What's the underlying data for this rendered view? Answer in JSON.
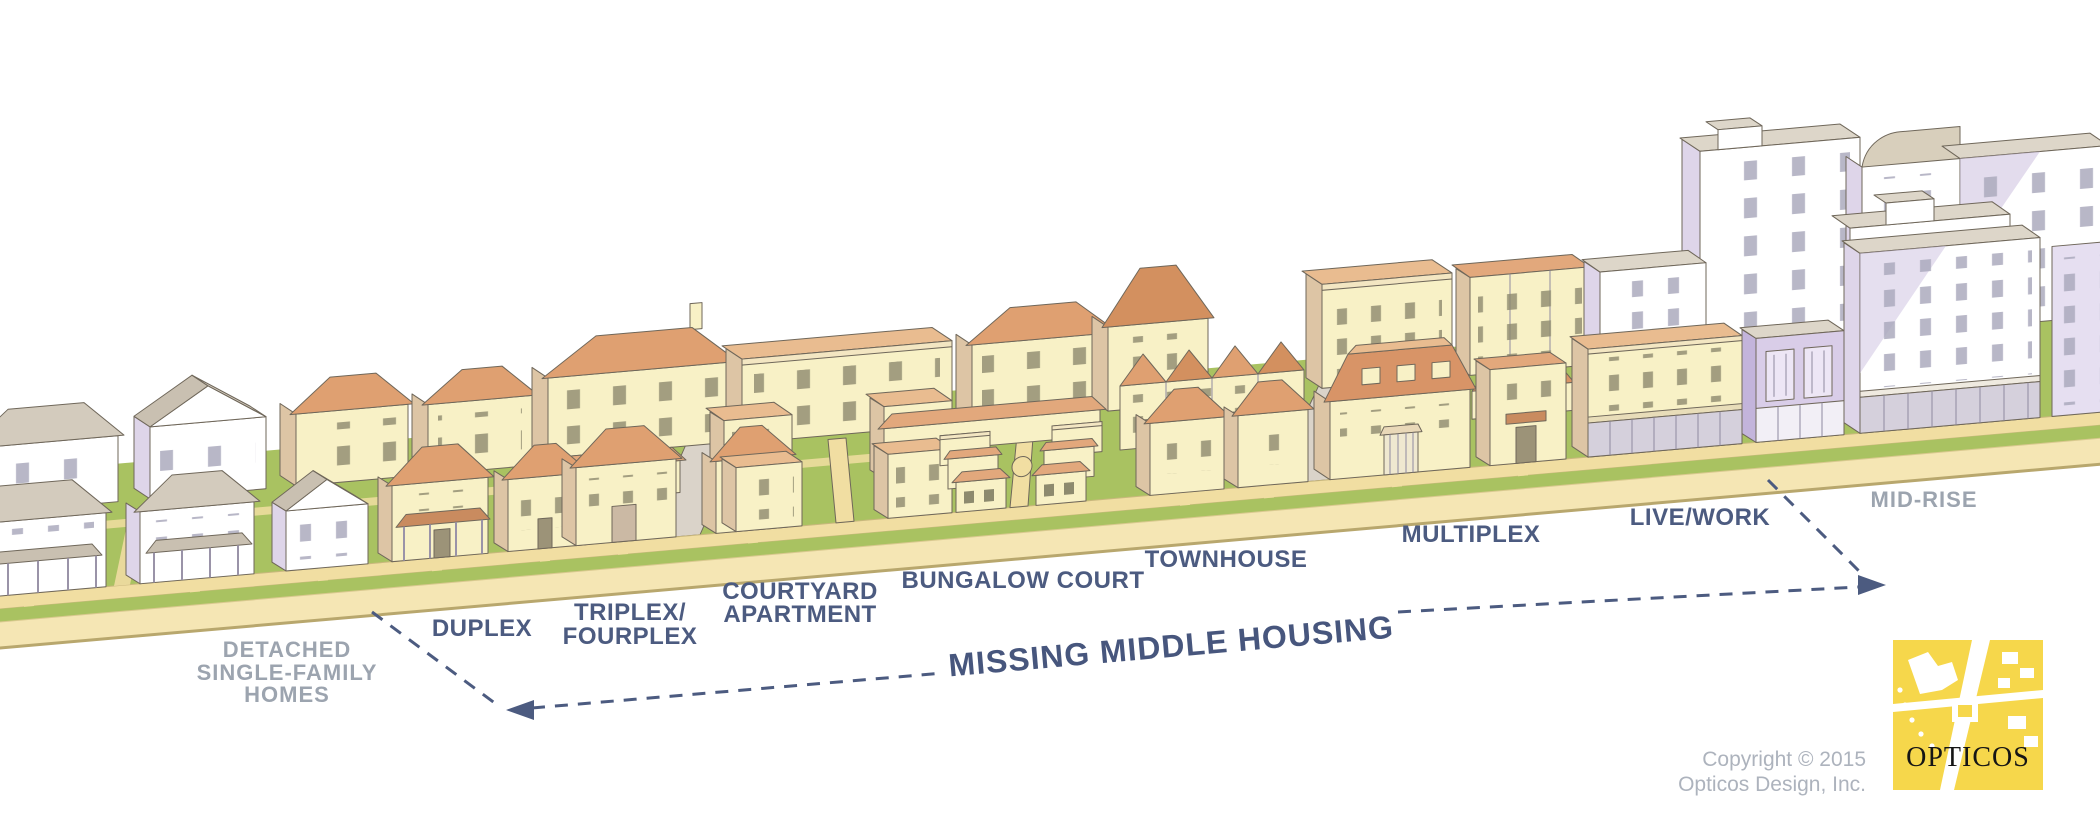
{
  "title": {
    "text": "MISSING MIDDLE HOUSING"
  },
  "types": [
    {
      "id": "detached",
      "lines": [
        "DETACHED",
        "SINGLE-FAMILY",
        "HOMES"
      ],
      "emphasis": "gray"
    },
    {
      "id": "duplex",
      "lines": [
        "DUPLEX"
      ],
      "emphasis": "navy"
    },
    {
      "id": "triplex-fourplex",
      "lines": [
        "TRIPLEX/",
        "FOURPLEX"
      ],
      "emphasis": "navy"
    },
    {
      "id": "courtyard-apartment",
      "lines": [
        "COURTYARD",
        "APARTMENT"
      ],
      "emphasis": "navy"
    },
    {
      "id": "bungalow-court",
      "lines": [
        "BUNGALOW COURT"
      ],
      "emphasis": "navy"
    },
    {
      "id": "townhouse",
      "lines": [
        "TOWNHOUSE"
      ],
      "emphasis": "navy"
    },
    {
      "id": "multiplex",
      "lines": [
        "MULTIPLEX"
      ],
      "emphasis": "navy"
    },
    {
      "id": "live-work",
      "lines": [
        "LIVE/WORK"
      ],
      "emphasis": "navy"
    },
    {
      "id": "mid-rise",
      "lines": [
        "MID-RISE"
      ],
      "emphasis": "gray"
    }
  ],
  "credit": {
    "line1": "Copyright © 2015",
    "line2": "Opticos Design, Inc."
  },
  "logo": {
    "wordmark": "OPTICOS",
    "background": "#F6D74B"
  },
  "palette": {
    "navy_label": "#4C5B80",
    "gray_label": "#9CA4AF",
    "credit_gray": "#ADB3BD",
    "cream_wall": "#F8F1C6",
    "terracotta_roof": "#DFA071",
    "white_wall": "#FFFFFF",
    "lavender_shade": "#DED5E9",
    "gray_roof": "#D3CBBD",
    "grass": "#A9C261",
    "street_tan": "#F5E6B4",
    "sidewalk_tan": "#F1DEA2",
    "logo_yellow": "#F6D74B"
  }
}
